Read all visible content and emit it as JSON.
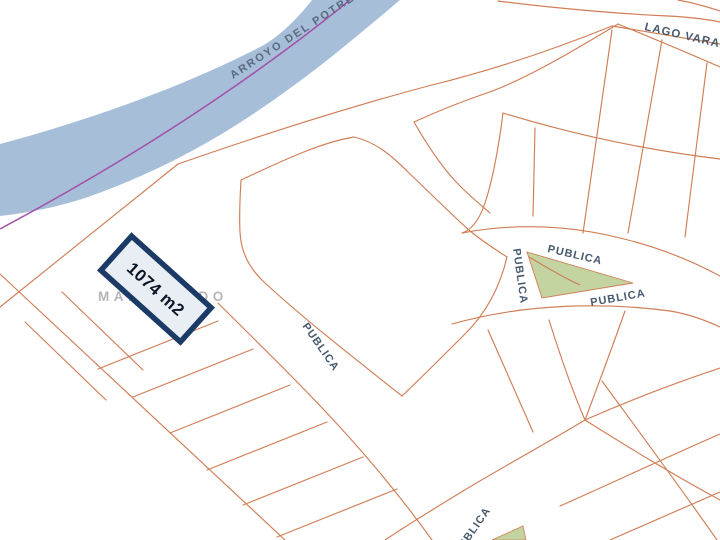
{
  "map": {
    "labels": {
      "river": "ARROYO DEL POTRERO",
      "street_lago": "LAGO VARANA",
      "street_maldonado": "MALDONADO",
      "publica_vertical": "PUBLICA",
      "publica_triangle_top": "PUBLICA",
      "publica_triangle_bottom": "PUBLICA",
      "publica_southwest": "PUBLICA",
      "publica_bottom": "PUBLICA"
    },
    "highlighted_parcel": {
      "area": "1074 m2"
    },
    "colors": {
      "river_fill": "#a6bed8",
      "river_centerline": "#a351a8",
      "parcel_line": "#cf7e56",
      "park_fill": "#c3d4a1",
      "highlight_border": "#1c3a66",
      "highlight_fill": "#e9eef5",
      "street_label": "#47596e",
      "river_label": "#5a6b80",
      "block_label_gray": "#b6b6b6"
    }
  }
}
